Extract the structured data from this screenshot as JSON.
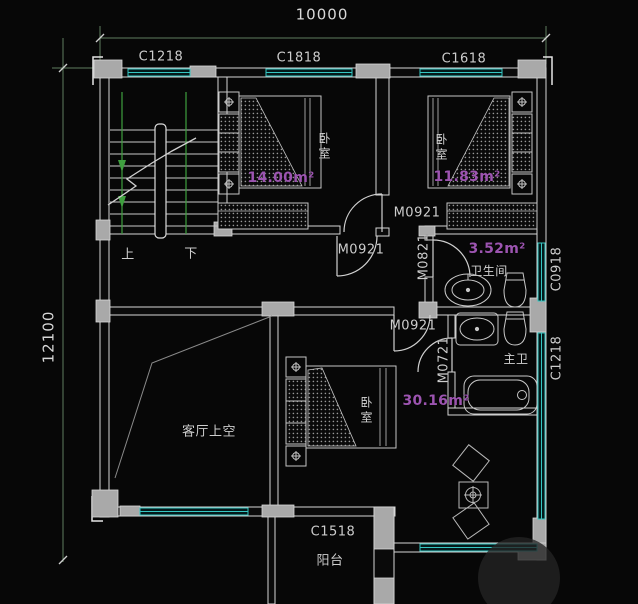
{
  "plan": {
    "dimensions": {
      "top": "10000",
      "left": "12100"
    },
    "windows": {
      "top_left": "C1218",
      "top_center": "C1818",
      "top_right": "C1618",
      "right_upper": "C0918",
      "right_lower": "C1218",
      "bottom": "C1518"
    },
    "doors": {
      "bedroom_right": "M0921",
      "hall_top": "M0921",
      "bath_upper": "M0821",
      "bedroom_bottom": "M0921",
      "bath_lower": "M0721"
    },
    "stairs": {
      "up": "上",
      "down": "下"
    },
    "rooms": {
      "bedroom_left": {
        "name": "卧室",
        "area": "14.00m²"
      },
      "bedroom_right": {
        "name": "卧室",
        "area": "11.83m²"
      },
      "bathroom": {
        "name": "卫生间",
        "area": "3.52m²"
      },
      "master_bathroom": {
        "name": "主卫"
      },
      "bedroom_bottom": {
        "name": "卧室",
        "area": "30.16m²"
      },
      "living_room_void": {
        "name": "客厅上空"
      },
      "balcony": {
        "name": "阳台"
      }
    },
    "colors": {
      "wall_line": "#d6d6d6",
      "column_fill": "#a9a9a9",
      "window_cyan": "#35c6c2",
      "dimension_green": "#5f7d5f",
      "stair_green": "#3fa03f",
      "area_magenta": "#9c54b0",
      "background": "#070707"
    }
  }
}
